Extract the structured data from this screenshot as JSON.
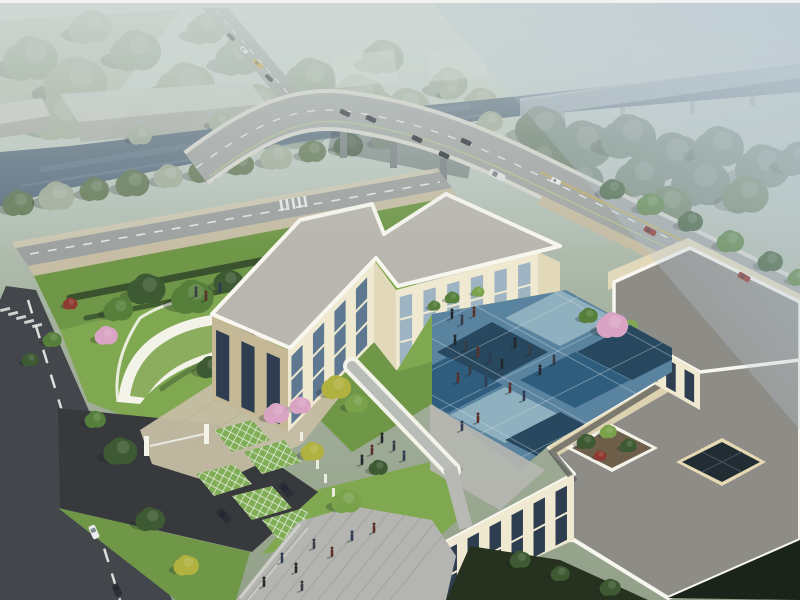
{
  "meta": {
    "title": "Aerial 3D architectural rendering: cream campus building with blue checkered courtyard beside a tree-lined river and curved highway overpass"
  },
  "scene": {
    "description": "Bird's-eye daytime rendering. Foreground: modern cream three-storey building wings around a blue diagonal-checker courtyard with pedestrians, a white covered walkway, and a large gray roof terrace holding a tree planter and a dark glass skylight. Landscaped grounds include a curved green-roof pavilion, pink blossom trees, lattice-paved parking pads with dark SUVs, a gated entry drive with barrier, lawns and hedges. A dark asphalt road with dashed centerline and crosswalk runs along the left. Behind the site, a gray avenue with a yellow bus leads to a curved vehicle overpass crossing a slate-blue river; cars and a white bus travel the bridge, two red cars on the near road. Hazy warehouses, forests and an elevated viaduct fade into blue-gray mist at the top.",
    "counts": {
      "trees": 94,
      "people": 35,
      "vehicles": 17
    }
  },
  "colors": {
    "haze_top": "#cfd8d4",
    "haze_mid": "#b9c6bd",
    "ground_far": "#a4b09c",
    "ground_near": "#93a18a",
    "haze_blue": "#bccbd6",
    "field": "#aab5a0",
    "forest_haze": "#93a390",
    "forest_haze2": "#a2ae9b",
    "forest_tr": "#6e8070",
    "tree_dark": "#3d5a33",
    "tree_green": "#567f3b",
    "tree_bright": "#79a24a",
    "tree_yellow": "#b0b13f",
    "tree_blossom": "#d9a4c4",
    "tree_red": "#8f3a30",
    "tree_bank": "#647a58",
    "river": "#5d7182",
    "river_light": "#7c93a3",
    "viaduct": "#c9d1d3",
    "pier": "#7a8285",
    "bridge_edge": "#d7d7cf",
    "bridge_deck": "#a2a6a4",
    "road_main": "#9da19f",
    "road_dash": "#eef0ec",
    "road_green_line": "#b4c98e",
    "road_yellow": "#c3ae5c",
    "road_dark": "#43464b",
    "road_dark2": "#38393d",
    "sidewalk": "#c6bda4",
    "paver_plaza": "#b4b5b1",
    "plaza_stripe": "#a3a4a0",
    "lawn": "#6f9747",
    "lawn_bright": "#7fa850",
    "hedge": "#3a522e",
    "green_roof": "#8cad5e",
    "canopy_white": "#f3f3ea",
    "wall_lit": "#f0e9d2",
    "wall_mid": "#e2d8ba",
    "wall_shadow": "#c4b897",
    "wall_warm": "#e6d9b4",
    "parapet": "#f7f6ef",
    "roof_light": "#b8b6af",
    "roof_gray": "#8d8c87",
    "roof_dark_band": "#5b5c5a",
    "glass_dark": "#2e3e50",
    "glass_mid": "#5d7890",
    "glass_light": "#9fb4c2",
    "window_frame": "#dde2e4",
    "court_blue_light": "#8fb0bf",
    "court_blue_mid": "#5a83a0",
    "court_blue_deep": "#2f5d7e",
    "court_blue_navy": "#27485e",
    "court_joint": "#d8dfe2",
    "lattice_green": "#7fae57",
    "lattice_line": "#eceee6",
    "warehouse_roof": "#c6c9c4",
    "warehouse_face": "#a9aca7",
    "vehicle_dark": "#2b2f36",
    "vehicle_white": "#e9edee",
    "vehicle_red": "#8e2a22",
    "bus_yellow": "#c2a23c",
    "bus_white": "#dfe3e2",
    "person": "#23262b",
    "shadow": "#1c2520",
    "person_variants": [
      "#23262b",
      "#383c44",
      "#5c2f2b",
      "#2e3b52"
    ]
  },
  "trees": {
    "far": [
      [
        30,
        60,
        26,
        "forest_haze"
      ],
      [
        75,
        84,
        30,
        "forest_haze2"
      ],
      [
        135,
        52,
        24,
        "forest_haze"
      ],
      [
        185,
        88,
        28,
        "forest_haze2"
      ],
      [
        238,
        58,
        22,
        "forest_haze"
      ],
      [
        60,
        118,
        28,
        "forest_haze2"
      ],
      [
        158,
        116,
        32,
        "forest_haze"
      ],
      [
        256,
        108,
        26,
        "forest_haze2"
      ],
      [
        310,
        80,
        24,
        "forest_haze"
      ],
      [
        356,
        100,
        28,
        "forest_haze2"
      ],
      [
        302,
        130,
        24,
        "forest_haze"
      ],
      [
        406,
        108,
        22,
        "forest_haze2"
      ],
      [
        382,
        58,
        20,
        "forest_haze"
      ],
      [
        448,
        84,
        18,
        "forest_haze"
      ],
      [
        480,
        102,
        16,
        "forest_haze2"
      ],
      [
        205,
        30,
        18,
        "forest_haze"
      ],
      [
        90,
        28,
        20,
        "forest_haze2"
      ]
    ],
    "bank": [
      [
        18,
        204,
        15,
        "tree_bank"
      ],
      [
        56,
        197,
        17,
        "forest_haze2"
      ],
      [
        94,
        190,
        14,
        "tree_bank"
      ],
      [
        132,
        184,
        16,
        "tree_bank"
      ],
      [
        168,
        177,
        14,
        "forest_haze2"
      ],
      [
        204,
        171,
        15,
        "tree_bank"
      ],
      [
        240,
        165,
        13,
        "tree_bank"
      ],
      [
        276,
        158,
        15,
        "forest_haze2"
      ],
      [
        312,
        152,
        13,
        "tree_bank"
      ],
      [
        348,
        146,
        14,
        "tree_bank"
      ],
      [
        384,
        140,
        12,
        "forest_haze2"
      ],
      [
        420,
        134,
        13,
        "tree_bank"
      ],
      [
        456,
        128,
        12,
        "tree_bank"
      ],
      [
        490,
        122,
        12,
        "forest_haze2"
      ],
      [
        140,
        136,
        11,
        "forest_haze2"
      ],
      [
        220,
        122,
        11,
        "forest_haze2"
      ],
      [
        300,
        112,
        11,
        "forest_haze2"
      ],
      [
        380,
        100,
        10,
        "forest_haze2"
      ],
      [
        450,
        92,
        10,
        "forest_haze2"
      ]
    ],
    "tr": [
      [
        540,
        128,
        24,
        "forest_tr"
      ],
      [
        582,
        146,
        28,
        "forest_tr"
      ],
      [
        628,
        138,
        26,
        "forest_tr"
      ],
      [
        672,
        158,
        28,
        "forest_tr"
      ],
      [
        718,
        148,
        24,
        "forest_tr"
      ],
      [
        762,
        168,
        26,
        "forest_tr"
      ],
      [
        798,
        160,
        20,
        "forest_tr"
      ],
      [
        700,
        184,
        28,
        "forest_tr"
      ],
      [
        640,
        178,
        24,
        "forest_tr"
      ],
      [
        580,
        182,
        22,
        "forest_tr"
      ],
      [
        745,
        196,
        22,
        "tree_bank"
      ],
      [
        610,
        200,
        20,
        "tree_bank"
      ],
      [
        668,
        206,
        22,
        "tree_bank"
      ],
      [
        540,
        160,
        20,
        "forest_tr"
      ]
    ],
    "site": [
      [
        146,
        290,
        18,
        "tree_dark"
      ],
      [
        192,
        298,
        20,
        "tree_green"
      ],
      [
        228,
        282,
        14,
        "tree_dark"
      ],
      [
        118,
        310,
        14,
        "tree_green"
      ],
      [
        258,
        318,
        13,
        "tree_dark"
      ],
      [
        296,
        330,
        15,
        "tree_green"
      ],
      [
        330,
        300,
        12,
        "tree_yellow"
      ],
      [
        356,
        314,
        11,
        "tree_bright"
      ],
      [
        386,
        320,
        10,
        "tree_dark"
      ],
      [
        106,
        336,
        11,
        "tree_blossom"
      ],
      [
        70,
        304,
        7,
        "tree_red"
      ],
      [
        240,
        388,
        12,
        "tree_bright"
      ],
      [
        210,
        368,
        13,
        "tree_dark"
      ],
      [
        612,
        190,
        12,
        "tree_dark"
      ],
      [
        650,
        205,
        13,
        "tree_green"
      ],
      [
        690,
        222,
        12,
        "tree_dark"
      ],
      [
        730,
        242,
        13,
        "tree_green"
      ],
      [
        770,
        262,
        12,
        "tree_dark"
      ],
      [
        798,
        278,
        10,
        "tree_green"
      ],
      [
        52,
        340,
        9,
        "tree_green"
      ],
      [
        30,
        360,
        8,
        "tree_dark"
      ]
    ],
    "front": [
      [
        336,
        388,
        14,
        "tree_yellow"
      ],
      [
        356,
        404,
        11,
        "tree_bright"
      ],
      [
        300,
        406,
        10,
        "tree_blossom"
      ],
      [
        276,
        414,
        12,
        "tree_blossom"
      ],
      [
        612,
        326,
        15,
        "tree_blossom"
      ],
      [
        588,
        316,
        9,
        "tree_green"
      ],
      [
        586,
        442,
        9,
        "tree_dark"
      ],
      [
        608,
        432,
        8,
        "tree_bright"
      ],
      [
        628,
        446,
        8,
        "tree_dark"
      ],
      [
        600,
        456,
        6,
        "tree_red"
      ],
      [
        120,
        452,
        16,
        "tree_dark"
      ],
      [
        150,
        520,
        14,
        "tree_dark"
      ],
      [
        186,
        566,
        12,
        "tree_yellow"
      ],
      [
        312,
        452,
        11,
        "tree_yellow"
      ],
      [
        346,
        502,
        14,
        "tree_bright"
      ],
      [
        378,
        468,
        9,
        "tree_dark"
      ],
      [
        95,
        420,
        10,
        "tree_green"
      ],
      [
        452,
        298,
        7,
        "tree_green"
      ],
      [
        478,
        292,
        6,
        "tree_bright"
      ],
      [
        520,
        560,
        10,
        "tree_dark"
      ],
      [
        560,
        574,
        9,
        "tree_dark"
      ],
      [
        610,
        588,
        10,
        "tree_dark"
      ],
      [
        434,
        306,
        6,
        "tree_green"
      ]
    ]
  },
  "people": [
    [
      455,
      342
    ],
    [
      466,
      348
    ],
    [
      478,
      354
    ],
    [
      490,
      360
    ],
    [
      502,
      366
    ],
    [
      470,
      372
    ],
    [
      458,
      380
    ],
    [
      486,
      384
    ],
    [
      515,
      345
    ],
    [
      530,
      352
    ],
    [
      510,
      390
    ],
    [
      524,
      398
    ],
    [
      540,
      372
    ],
    [
      554,
      362
    ],
    [
      478,
      420
    ],
    [
      462,
      428
    ],
    [
      382,
      440
    ],
    [
      394,
      448
    ],
    [
      372,
      452
    ],
    [
      404,
      458
    ],
    [
      362,
      462
    ],
    [
      196,
      294
    ],
    [
      206,
      298
    ],
    [
      220,
      290
    ],
    [
      452,
      316
    ],
    [
      462,
      322
    ],
    [
      474,
      314
    ],
    [
      282,
      560
    ],
    [
      296,
      570
    ],
    [
      314,
      546
    ],
    [
      332,
      554
    ],
    [
      352,
      538
    ],
    [
      264,
      584
    ],
    [
      302,
      588
    ],
    [
      374,
      530
    ]
  ],
  "vehicles": [
    [
      258,
      64,
      5,
      12,
      -47,
      "bus_yellow"
    ],
    [
      244,
      50,
      4,
      9,
      -47,
      "vehicle_white"
    ],
    [
      231,
      37,
      4,
      9,
      -47,
      "vehicle_dark"
    ],
    [
      269,
      78,
      4,
      9,
      -47,
      "vehicle_dark"
    ],
    [
      345,
      113,
      5,
      11,
      -64,
      "vehicle_dark"
    ],
    [
      371,
      119,
      5,
      11,
      -64,
      "vehicle_dark"
    ],
    [
      417,
      139,
      5,
      11,
      -64,
      "vehicle_dark"
    ],
    [
      466,
      142,
      5,
      11,
      -64,
      "vehicle_dark"
    ],
    [
      444,
      155,
      5,
      11,
      -64,
      "vehicle_dark"
    ],
    [
      497,
      175,
      7,
      17,
      -64,
      "bus_white"
    ],
    [
      556,
      181,
      5,
      10,
      -64,
      "vehicle_white"
    ],
    [
      650,
      231,
      6,
      13,
      -62,
      "vehicle_red"
    ],
    [
      744,
      277,
      6,
      13,
      -60,
      "vehicle_red"
    ],
    [
      94,
      532,
      7,
      14,
      -24,
      "vehicle_white"
    ],
    [
      117,
      590,
      7,
      13,
      -24,
      "vehicle_dark"
    ],
    [
      224,
      516,
      8,
      16,
      -40,
      "vehicle_dark"
    ],
    [
      286,
      490,
      8,
      16,
      -40,
      "vehicle_dark"
    ]
  ],
  "facades": [
    {
      "wall": "west-wing-southeast",
      "ox": 288,
      "oy": 350,
      "ux": 86,
      "uy": -90,
      "vh": 82,
      "top": 10,
      "cols": 4,
      "glass": "glass_mid",
      "floors": 3
    },
    {
      "wall": "north-wing-courtyard",
      "ox": 396,
      "oy": 290,
      "ux": 142,
      "uy": -38,
      "vh": 80,
      "top": 8,
      "cols": 6,
      "glass": "glass_light",
      "floors": 3
    },
    {
      "wall": "west-wing-southwest",
      "ox": 212,
      "oy": 316,
      "ux": 76,
      "uy": 34,
      "vh": 82,
      "top": 12,
      "cols": 3,
      "glass": "glass_dark",
      "floors": 0
    },
    {
      "wall": "front-wing-northwest",
      "ox": 442,
      "oy": 544,
      "ux": 132,
      "uy": -70,
      "vh": 66,
      "top": 8,
      "cols": 6,
      "glass": "glass_dark",
      "floors": 2
    },
    {
      "wall": "east-wing-courtyard",
      "ox": 608,
      "oy": 320,
      "ux": 92,
      "uy": 52,
      "vh": 38,
      "top": 6,
      "cols": 5,
      "glass": "glass_dark",
      "floors": 0
    }
  ],
  "courtyard_grid": {
    "origin": [
      420,
      332
    ],
    "u": [
      54,
      -27
    ],
    "v": [
      42,
      23
    ],
    "nu": 7,
    "nv": 6
  }
}
